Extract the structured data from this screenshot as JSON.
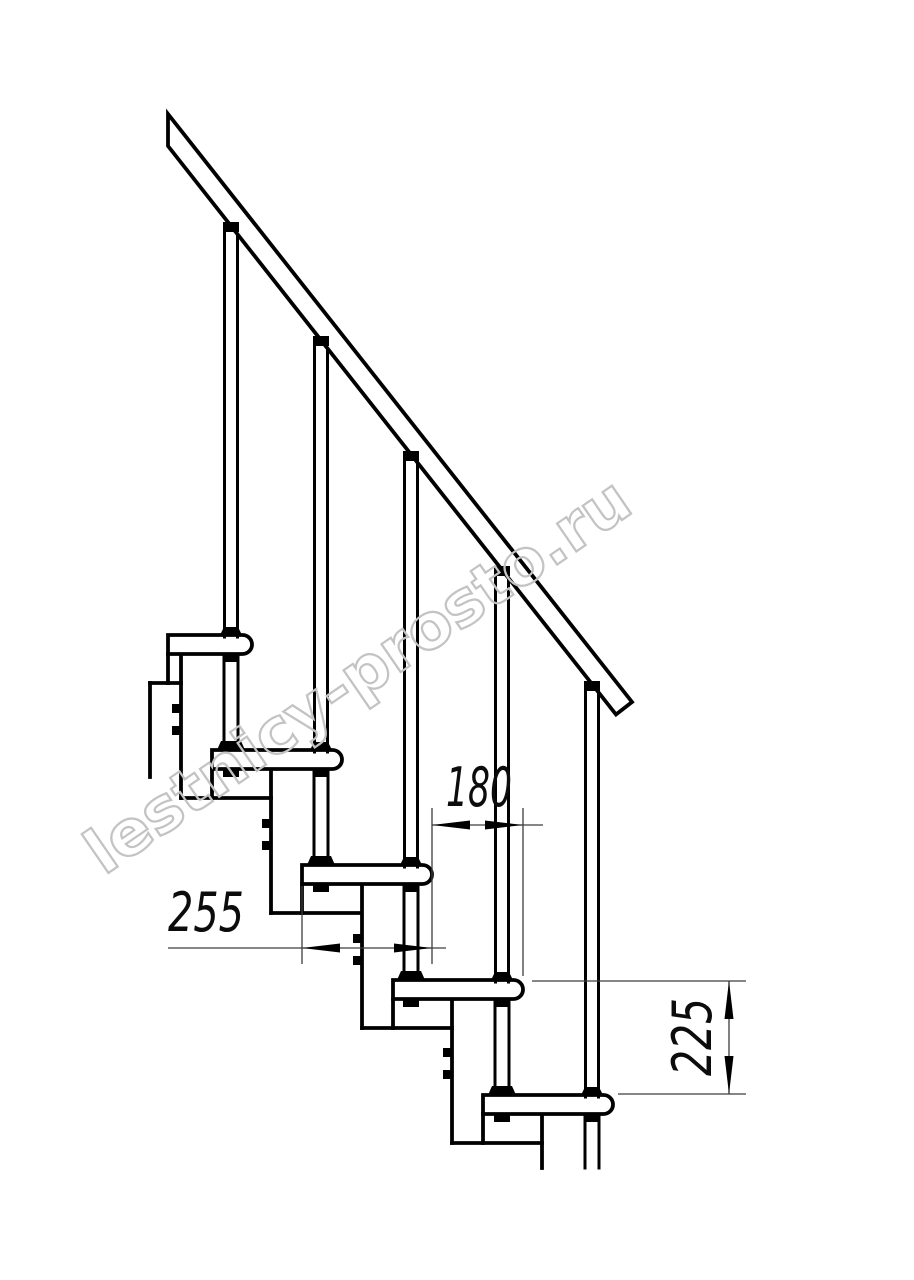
{
  "drawing": {
    "title": "modular-staircase-side-view",
    "watermark": "lestnicy-prosto.ru",
    "dimensions": {
      "step_run": "180",
      "tread_depth": "255",
      "step_rise": "225"
    },
    "step_count": 5
  },
  "colors": {
    "line": "#000000",
    "dim_line": "#3d3d3d",
    "dim_text": "#0c0c0c",
    "watermark": "#c3c3c3",
    "background": "#ffffff"
  }
}
